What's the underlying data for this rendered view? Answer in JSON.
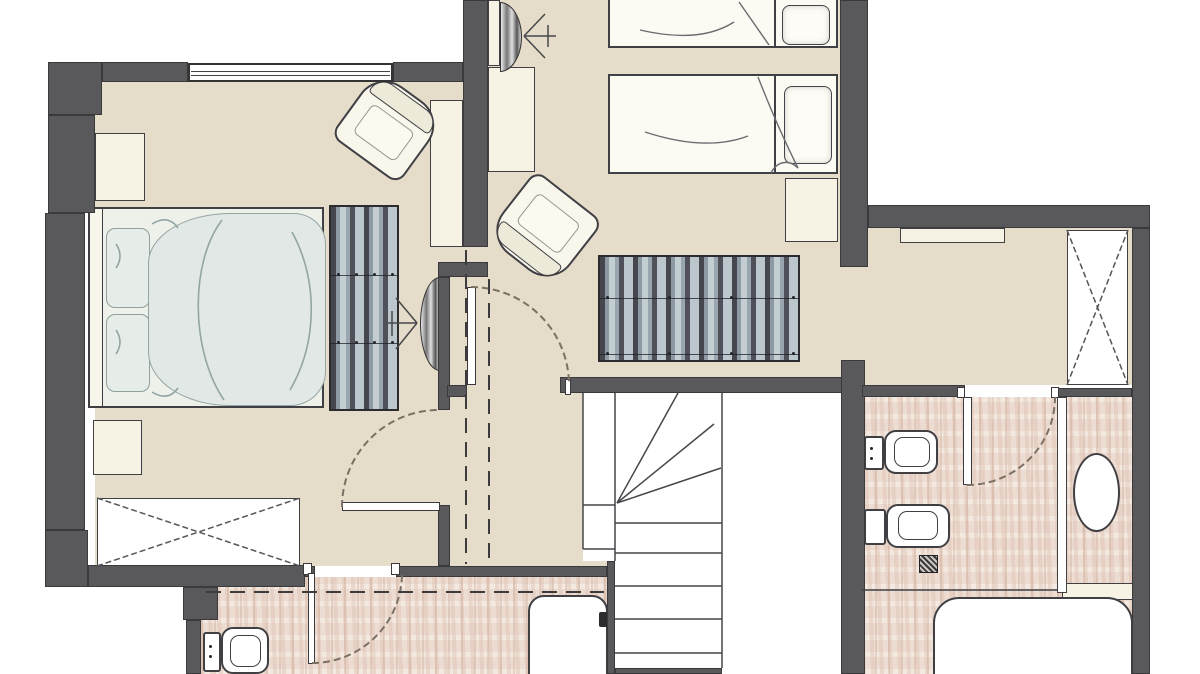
{
  "meta": {
    "kind": "architectural-floor-plan",
    "level": "attic-floor",
    "width": 1200,
    "height": 674
  },
  "colors": {
    "wall": "#59595c",
    "wallEdge": "#3a3a3c",
    "beige": "#e5dcc9",
    "tileBase": "#ecdcd2",
    "cream": "#f6f3e4",
    "outline": "#3f3f44",
    "duvet": "#e1e8e5",
    "duvetLine": "#93a5a2",
    "arc": "#7b7064",
    "dash": "#3c3c3e",
    "stair": "#47474b",
    "cross": "#55555a"
  },
  "rooms": [
    {
      "name": "master-bedroom",
      "floor": "beige"
    },
    {
      "name": "twin-sleeping-area",
      "floor": "beige"
    },
    {
      "name": "upper-hall",
      "floor": "beige"
    },
    {
      "name": "lower-hall",
      "floor": "beige"
    },
    {
      "name": "east-corridor",
      "floor": "beige"
    },
    {
      "name": "bathroom-left",
      "floor": "tile"
    },
    {
      "name": "bathroom-right",
      "floor": "tile"
    },
    {
      "name": "stairwell",
      "floor": "white"
    }
  ],
  "floors": {
    "beige": [
      [
        95,
        82,
        368,
        484
      ],
      [
        463,
        0,
        377,
        393
      ],
      [
        838,
        228,
        294,
        157
      ],
      [
        438,
        385,
        177,
        181
      ]
    ],
    "tile": [
      [
        201,
        577,
        406,
        97
      ],
      [
        862,
        397,
        270,
        277
      ]
    ],
    "white": [
      [
        583,
        393,
        260,
        168
      ],
      [
        615,
        561,
        228,
        113
      ]
    ]
  },
  "walls": [
    {
      "name": "wall-top-left-corner",
      "r": [
        48,
        62,
        54,
        53
      ]
    },
    {
      "name": "wall-top-a",
      "r": [
        102,
        62,
        86,
        20
      ]
    },
    {
      "name": "wall-top-b",
      "r": [
        393,
        62,
        70,
        20
      ]
    },
    {
      "name": "wall-left-upper",
      "r": [
        48,
        115,
        47,
        98
      ]
    },
    {
      "name": "wall-left-mid",
      "r": [
        45,
        213,
        40,
        317
      ]
    },
    {
      "name": "wall-left-corner",
      "r": [
        45,
        530,
        43,
        57
      ]
    },
    {
      "name": "wall-south-west",
      "r": [
        88,
        565,
        217,
        22
      ]
    },
    {
      "name": "wall-south-step",
      "r": [
        183,
        587,
        35,
        33
      ]
    },
    {
      "name": "wall-south-low",
      "r": [
        186,
        620,
        15,
        54
      ]
    },
    {
      "name": "wall-twin-west",
      "r": [
        463,
        0,
        25,
        247
      ]
    },
    {
      "name": "wall-jog",
      "r": [
        438,
        262,
        50,
        15
      ]
    },
    {
      "name": "wall-master-east-upper",
      "r": [
        438,
        277,
        12,
        133
      ]
    },
    {
      "name": "wall-door-jamb-ne",
      "r": [
        447,
        385,
        20,
        12
      ]
    },
    {
      "name": "wall-master-east-lower",
      "r": [
        438,
        505,
        12,
        61
      ]
    },
    {
      "name": "wall-stair-north",
      "r": [
        560,
        377,
        283,
        16
      ]
    },
    {
      "name": "wall-stair-east",
      "r": [
        841,
        360,
        24,
        314
      ]
    },
    {
      "name": "wall-twin-east",
      "r": [
        840,
        0,
        28,
        267
      ]
    },
    {
      "name": "wall-east-top",
      "r": [
        868,
        205,
        282,
        23
      ]
    },
    {
      "name": "wall-right-outer",
      "r": [
        1132,
        228,
        18,
        446
      ]
    },
    {
      "name": "wall-bath-north-a",
      "r": [
        862,
        385,
        103,
        12
      ]
    },
    {
      "name": "wall-bath-north-b",
      "r": [
        1057,
        388,
        75,
        9
      ]
    },
    {
      "name": "wall-hall-south-a",
      "r": [
        305,
        566,
        10,
        11
      ]
    },
    {
      "name": "wall-hall-south-b",
      "r": [
        396,
        566,
        211,
        11
      ]
    },
    {
      "name": "wall-stair-west",
      "r": [
        607,
        561,
        8,
        113
      ]
    },
    {
      "name": "wall-stair-south",
      "r": [
        615,
        668,
        107,
        6
      ]
    }
  ],
  "window": {
    "name": "window-master-north",
    "rect": [
      188,
      63,
      205,
      19
    ],
    "lines": [
      6,
      10
    ]
  },
  "jambs": [
    {
      "name": "jamb-hall-door",
      "r": [
        565,
        379,
        6,
        16
      ]
    },
    {
      "name": "jamb-bath-left-a",
      "r": [
        303,
        563,
        9,
        12
      ]
    },
    {
      "name": "jamb-bath-left-b",
      "r": [
        391,
        563,
        9,
        12
      ]
    },
    {
      "name": "jamb-bath-right-a",
      "r": [
        957,
        387,
        8,
        11
      ]
    },
    {
      "name": "jamb-bath-right-b",
      "r": [
        1051,
        387,
        8,
        11
      ]
    }
  ],
  "doors": [
    {
      "name": "door-master-bedroom",
      "leaf": [
        342,
        502,
        98,
        9
      ],
      "arc": "M342,507 A97,97 0 0 1 440,410"
    },
    {
      "name": "door-upper-hall",
      "leaf": [
        467,
        287,
        9,
        98
      ],
      "arc": "M471,287 A98,98 0 0 1 569,385"
    },
    {
      "name": "door-bathroom-left",
      "leaf": [
        308,
        573,
        7,
        91
      ],
      "arc": "M312,663 A90,90 0 0 0 402,573"
    },
    {
      "name": "door-bathroom-right",
      "leaf": [
        963,
        397,
        9,
        88
      ],
      "arc": "M967,485 A88,88 0 0 0 1055,397"
    }
  ],
  "furniture": {
    "creamBoxes": [
      {
        "name": "nightstand-master-a",
        "r": [
          95,
          133,
          50,
          68
        ]
      },
      {
        "name": "nightstand-master-b",
        "r": [
          93,
          420,
          49,
          55
        ]
      },
      {
        "name": "desk-twin-room",
        "r": [
          488,
          67,
          47,
          105
        ]
      },
      {
        "name": "cabinet-master-east",
        "r": [
          430,
          100,
          33,
          147
        ]
      },
      {
        "name": "nightstand-twin",
        "r": [
          785,
          178,
          53,
          64
        ]
      },
      {
        "name": "shelf-east-corridor",
        "r": [
          900,
          228,
          105,
          15
        ]
      },
      {
        "name": "shelf-bathroom-right",
        "r": [
          1062,
          583,
          71,
          17
        ]
      },
      {
        "name": "tv-panel-twin",
        "r": [
          488,
          0,
          12,
          66
        ]
      }
    ],
    "wardrobes": [
      {
        "name": "wardrobe-master",
        "r": [
          97,
          498,
          203,
          68
        ]
      },
      {
        "name": "wardrobe-east-corridor",
        "r": [
          1067,
          230,
          61,
          155
        ]
      }
    ],
    "striped": [
      {
        "name": "dresser-master",
        "r": [
          329,
          205,
          70,
          206
        ],
        "seams": [
          68,
          136
        ],
        "dots": 4
      },
      {
        "name": "bench-upper-hall",
        "r": [
          598,
          255,
          202,
          107
        ],
        "seams": [
          41,
          97
        ],
        "dots": 4
      }
    ],
    "chairs": [
      {
        "name": "armchair-master",
        "cx": 388,
        "cy": 127,
        "w": 84,
        "h": 82,
        "angle": 36,
        "back": "n"
      },
      {
        "name": "armchair-hall",
        "cx": 544,
        "cy": 229,
        "w": 86,
        "h": 84,
        "angle": 38,
        "back": "s"
      }
    ],
    "bedMaster": {
      "name": "bed-master",
      "frame": [
        88,
        207,
        236,
        201
      ],
      "headboardW": 13,
      "pillows": [
        [
          16,
          19,
          44,
          80
        ],
        [
          16,
          105,
          44,
          78
        ]
      ],
      "duvet": [
        58,
        4,
        178,
        193
      ]
    },
    "bedsTwin": [
      {
        "name": "bed-twin-1",
        "frame": [
          608,
          -4,
          230,
          52
        ],
        "divider": 164,
        "pillow": [
          172,
          7,
          48,
          40
        ]
      },
      {
        "name": "bed-twin-2",
        "frame": [
          608,
          74,
          230,
          100
        ],
        "divider": 164,
        "pillow": [
          174,
          10,
          48,
          78
        ]
      }
    ],
    "tvs": [
      {
        "name": "tv-master-wall",
        "r": [
          420,
          277,
          20,
          94
        ],
        "side": "w"
      },
      {
        "name": "tv-twin-wall",
        "r": [
          500,
          2,
          22,
          70
        ],
        "side": "e"
      }
    ]
  },
  "fixtures": {
    "toilets": [
      {
        "name": "toilet-bathroom-left",
        "tank": [
          203,
          632,
          18,
          40
        ],
        "bowl": [
          221,
          627,
          48,
          47
        ],
        "inner": [
          230,
          635,
          31,
          32
        ],
        "dots": [
          [
            209,
            645
          ],
          [
            209,
            655
          ]
        ]
      },
      {
        "name": "toilet-bathroom-right",
        "tank": [
          864,
          436,
          20,
          34
        ],
        "bowl": [
          884,
          430,
          54,
          44
        ],
        "inner": [
          894,
          437,
          36,
          30
        ],
        "dots": [
          [
            870,
            447
          ],
          [
            870,
            457
          ]
        ]
      },
      {
        "name": "bidet-bathroom-right",
        "tank": [
          864,
          509,
          22,
          36
        ],
        "bowl": [
          886,
          504,
          64,
          44
        ],
        "inner": [
          898,
          511,
          40,
          29
        ],
        "dots": []
      }
    ],
    "drain": {
      "name": "floor-drain",
      "r": [
        919,
        555,
        19,
        18
      ]
    },
    "basin": {
      "name": "washbasin-oval",
      "r": [
        1073,
        453,
        47,
        79
      ]
    },
    "tubs": [
      {
        "name": "bathtub-right",
        "r": [
          933,
          597,
          200,
          100
        ],
        "radius": "26px 26px 10px 10px"
      },
      {
        "name": "bathtub-left",
        "r": [
          528,
          595,
          80,
          95
        ],
        "radius": "16px 16px 6px 6px",
        "faucet": [
          599,
          612,
          9,
          15
        ]
      }
    ],
    "partition": {
      "name": "partition-bathroom-right",
      "r": [
        1057,
        397,
        10,
        196
      ]
    }
  },
  "stairs": {
    "name": "staircase-winder",
    "lines": [
      "M583,393 L583,549",
      "M615,393 L615,561",
      "M722,393 L722,668",
      "M583,505 L615,505",
      "M583,549 L615,549",
      "M615,523 L722,523",
      "M615,553 L722,553",
      "M615,586 L722,586",
      "M615,619 L722,619",
      "M615,653 L722,653",
      "M617,503 L678,393",
      "M617,503 L714,424",
      "M617,503 L721,468"
    ]
  },
  "overlay": {
    "dashed_ceiling_lines": [
      "M466,250 L466,564",
      "M489,279 L489,564",
      "M206,592 L604,592"
    ],
    "wardrobe_crosses": [
      "M97,498 L300,566",
      "M97,566 L300,498",
      "M1067,230 L1128,385",
      "M1067,385 L1128,230"
    ],
    "tv_rays": [
      "M417,323 L396,298",
      "M417,323 L388,323",
      "M417,323 L396,349",
      "M392,311 L392,336",
      "M524,36 L545,14",
      "M524,36 L556,36",
      "M524,36 L545,58",
      "M548,25 L548,47"
    ],
    "duvet_folds": [
      "M222,220 C190,262 190,350 224,400",
      "M292,232 C318,280 318,342 290,390",
      "M152,224 Q168,214 178,228",
      "M152,392 Q168,402 178,388",
      "M116,244 q8,12 0,24",
      "M116,330 q8,12 0,24"
    ],
    "twin_folds": [
      "M739,2 L769,45",
      "M758,77 C774,118 788,148 798,168",
      "M798,168 C789,159 777,161 771,173",
      "M640,30 Q700,44 734,22",
      "M645,132 Q706,152 748,136"
    ],
    "bath_partition_line": [
      "M862,590 L1057,590"
    ]
  }
}
